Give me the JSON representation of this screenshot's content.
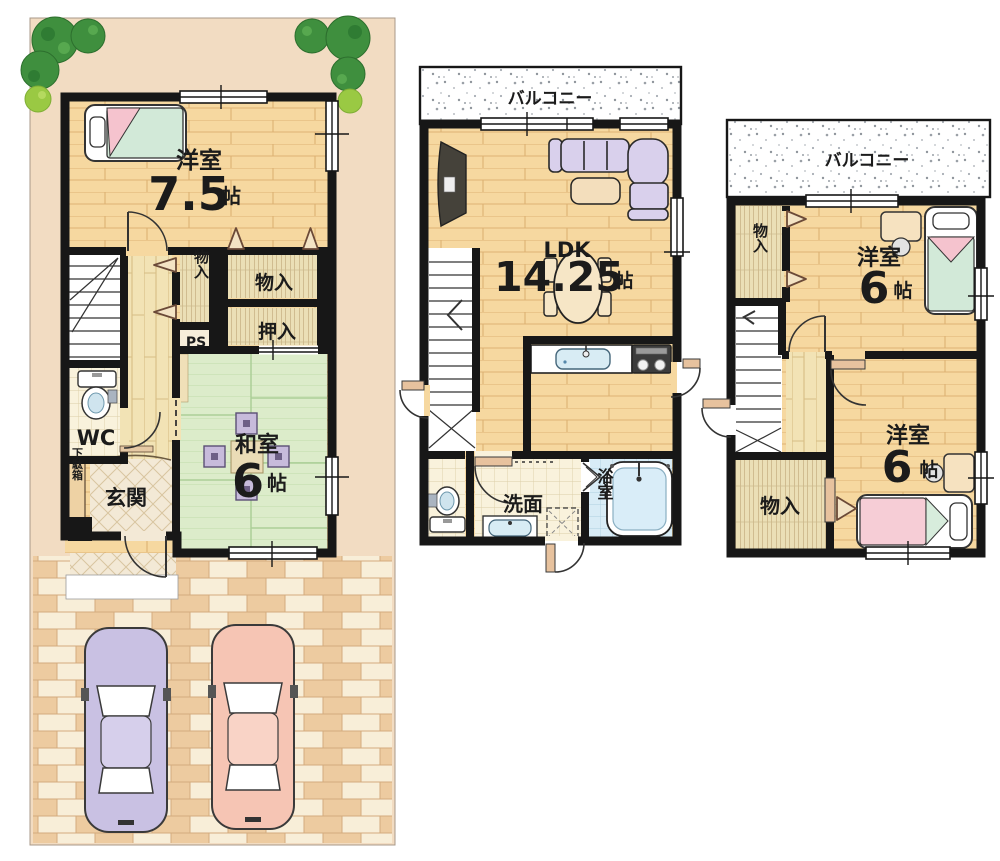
{
  "floor1": {
    "western_room": {
      "label": "洋室",
      "size": "7.5",
      "unit": "帖"
    },
    "storage_hall": "物入",
    "storage_wide": "物入",
    "oshiire": "押入",
    "pipe_space": "PS",
    "toilet": "WC",
    "shoe_cabinet": "下駄箱",
    "entrance": "玄関",
    "japanese_room": {
      "label": "和室",
      "size": "6",
      "unit": "帖"
    }
  },
  "floor2": {
    "balcony": "バルコニー",
    "ldk": {
      "label": "LDK",
      "size": "14.25",
      "unit": "帖"
    },
    "washroom": "洗面",
    "bathroom": "浴室"
  },
  "floor3": {
    "balcony": "バルコニー",
    "storage_top": "物入",
    "western_room_top": {
      "label": "洋室",
      "size": "6",
      "unit": "帖"
    },
    "storage_bottom": "物入",
    "western_room_bottom": {
      "label": "洋室",
      "size": "6",
      "unit": "帖"
    }
  },
  "colors": {
    "wall": "#171717",
    "wood_floor": "#f6d8a0",
    "tatami": "#dcecca",
    "site": "#f2dcc2",
    "brick": "#edcba0",
    "sofa": "#d9d0ec",
    "car_purple": "#c9c1e3",
    "car_pink": "#f6c5b4",
    "bed_green": "#d2e9d8",
    "bed_pink": "#f6cdd6",
    "bath_blue": "#d8ecf6"
  }
}
